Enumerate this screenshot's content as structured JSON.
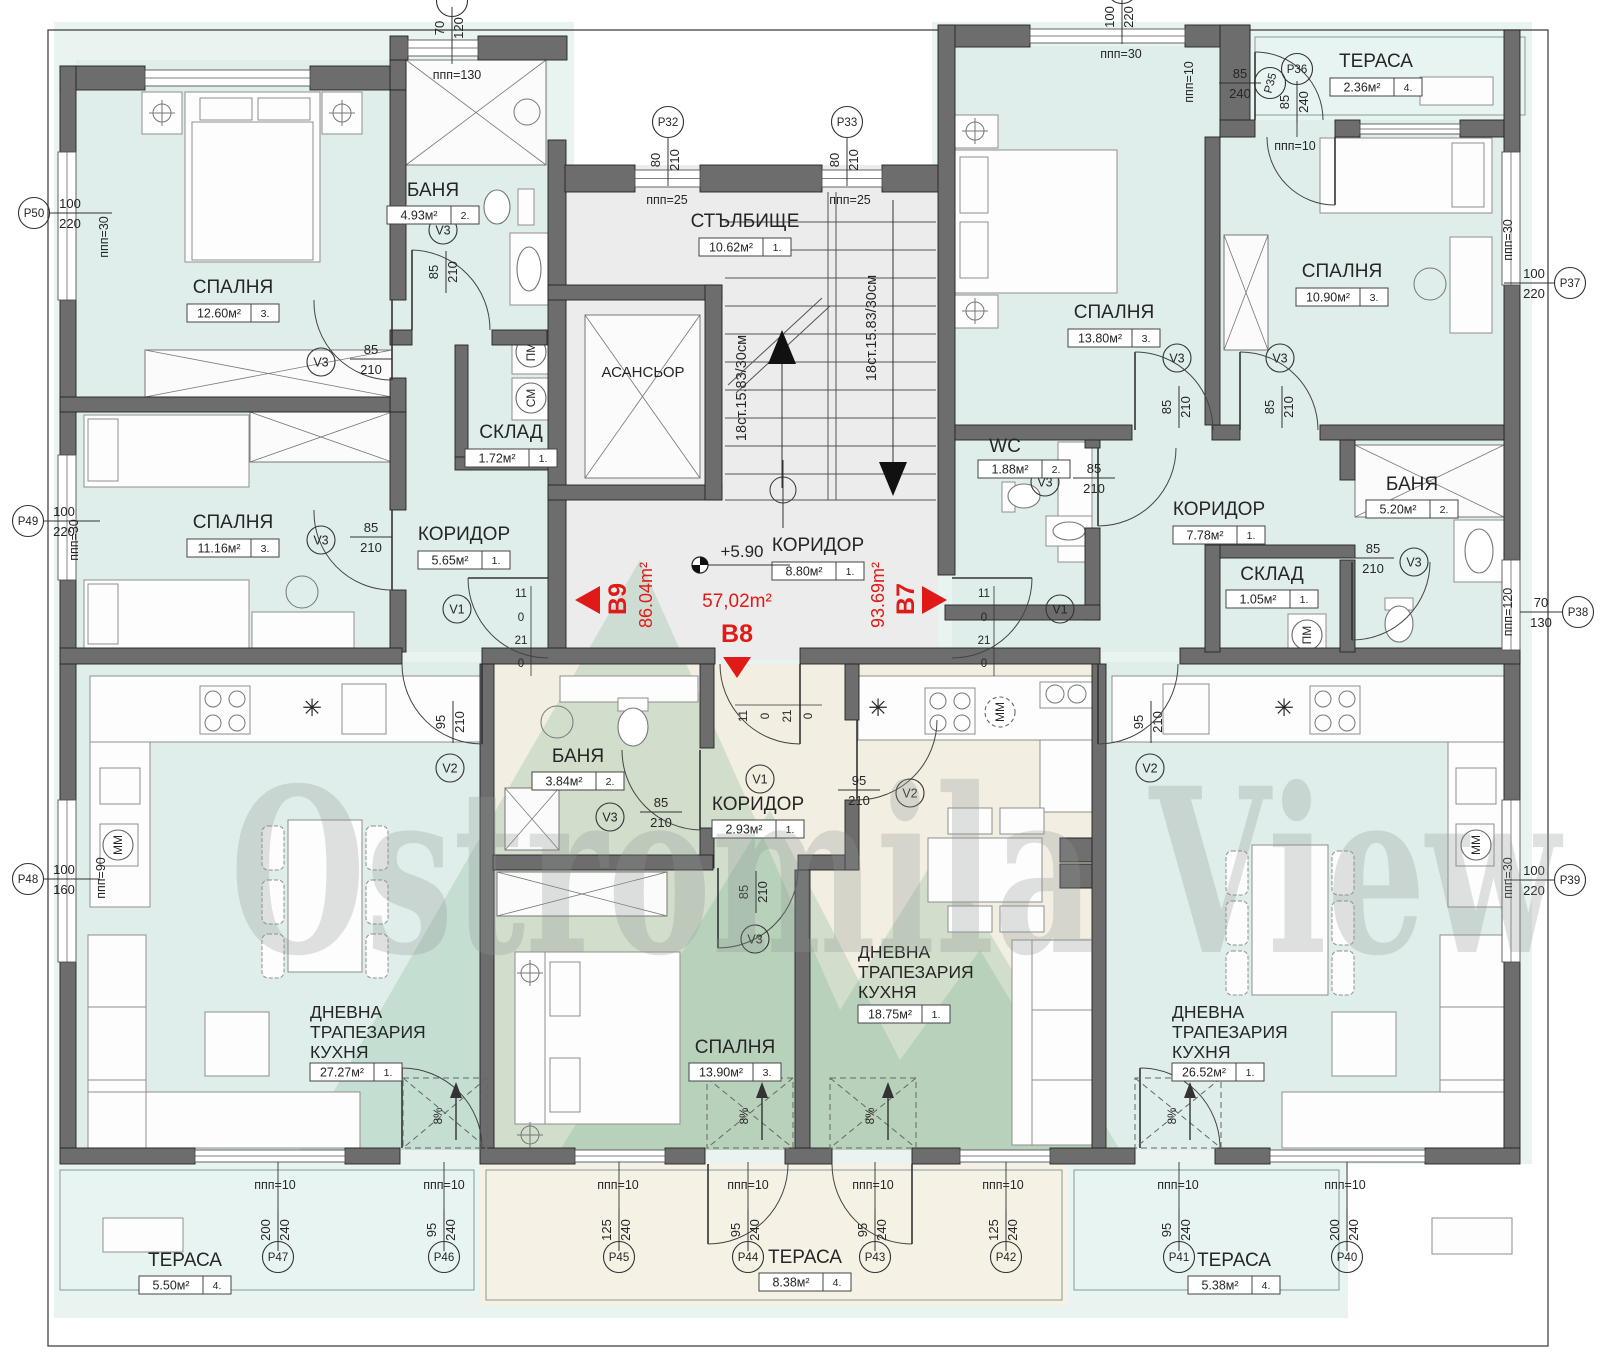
{
  "watermark": {
    "text": "Ostromila View"
  },
  "level_mark": "+5.90",
  "stair_note": "18ст.15.83/30см",
  "units": [
    {
      "id": "B9",
      "area": "86.04m²"
    },
    {
      "id": "B8",
      "area": "57,02m²"
    },
    {
      "id": "B7",
      "area": "93.69m²"
    }
  ],
  "rooms": [
    {
      "n": [
        "СПАЛНЯ"
      ],
      "a": "12.60м²",
      "u": "3.",
      "x": 233,
      "y": 293,
      "by": 313
    },
    {
      "n": [
        "БАНЯ"
      ],
      "a": "4.93м²",
      "u": "2.",
      "x": 433,
      "y": 196,
      "by": 215
    },
    {
      "n": [
        "СПАЛНЯ"
      ],
      "a": "11.16м²",
      "u": "3.",
      "x": 233,
      "y": 528,
      "by": 548
    },
    {
      "n": [
        "КОРИДОР"
      ],
      "a": "5.65м²",
      "u": "1.",
      "x": 464,
      "y": 540,
      "by": 560
    },
    {
      "n": [
        "СКЛАД"
      ],
      "a": "1.72м²",
      "u": "1.",
      "x": 511,
      "y": 438,
      "by": 458
    },
    {
      "n": [
        "СТЪЛБИЩЕ"
      ],
      "a": "10.62м²",
      "u": "1.",
      "x": 745,
      "y": 227,
      "by": 247
    },
    {
      "n": [
        "АСАНСЬОР"
      ],
      "x": 643,
      "y": 377,
      "nobox": 1
    },
    {
      "n": [
        "КОРИДОР"
      ],
      "a": "8.80м²",
      "u": "1.",
      "x": 818,
      "y": 551,
      "by": 571
    },
    {
      "n": [
        "СПАЛНЯ"
      ],
      "a": "13.80м²",
      "u": "3.",
      "x": 1114,
      "y": 318,
      "by": 338
    },
    {
      "n": [
        "СПАЛНЯ"
      ],
      "a": "10.90м²",
      "u": "3.",
      "x": 1342,
      "y": 277,
      "by": 297
    },
    {
      "n": [
        "ТЕРАСА"
      ],
      "a": "2.36м²",
      "u": "4.",
      "x": 1376,
      "y": 67,
      "by": 87
    },
    {
      "n": [
        "WC"
      ],
      "a": "1.88м²",
      "u": "2.",
      "x": 1005,
      "y": 452,
      "by": 469,
      "ax": 1024
    },
    {
      "n": [
        "КОРИДОР"
      ],
      "a": "7.78м²",
      "u": "1.",
      "x": 1219,
      "y": 515,
      "by": 535
    },
    {
      "n": [
        "БАНЯ"
      ],
      "a": "5.20м²",
      "u": "2.",
      "x": 1412,
      "y": 490,
      "by": 509
    },
    {
      "n": [
        "СКЛАД"
      ],
      "a": "1.05м²",
      "u": "1.",
      "x": 1272,
      "y": 580,
      "by": 599
    },
    {
      "n": [
        "БАНЯ"
      ],
      "a": "3.84м²",
      "u": "2.",
      "x": 578,
      "y": 762,
      "by": 781
    },
    {
      "n": [
        "КОРИДОР"
      ],
      "a": "2.93м²",
      "u": "1.",
      "x": 758,
      "y": 810,
      "by": 829
    },
    {
      "n": [
        "СПАЛНЯ"
      ],
      "a": "13.90м²",
      "u": "3.",
      "x": 735,
      "y": 1053,
      "by": 1072
    },
    {
      "n": [
        "ДНЕВНА",
        "ТРАПЕЗАРИЯ",
        "КУХНЯ"
      ],
      "a": "18.75м²",
      "u": "1.",
      "x": 858,
      "y": 958,
      "by": 1014,
      "left": 1
    },
    {
      "n": [
        "ДНЕВНА",
        "ТРАПЕЗАРИЯ",
        "КУХНЯ"
      ],
      "a": "27.27м²",
      "u": "1.",
      "x": 310,
      "y": 1018,
      "by": 1072,
      "left": 1
    },
    {
      "n": [
        "ДНЕВНА",
        "ТРАПЕЗАРИЯ",
        "КУХНЯ"
      ],
      "a": "26.52м²",
      "u": "1.",
      "x": 1172,
      "y": 1018,
      "by": 1072,
      "left": 1
    },
    {
      "n": [
        "ТЕРАСА"
      ],
      "a": "5.50м²",
      "u": "4.",
      "x": 185,
      "y": 1266,
      "by": 1285
    },
    {
      "n": [
        "ТЕРАСА"
      ],
      "a": "8.38м²",
      "u": "4.",
      "x": 805,
      "y": 1263,
      "by": 1282
    },
    {
      "n": [
        "ТЕРАСА"
      ],
      "a": "5.38м²",
      "u": "4.",
      "x": 1234,
      "y": 1266,
      "by": 1285
    }
  ],
  "p_markers": [
    {
      "id": "P50",
      "t": "100",
      "b": "220",
      "cx": 34,
      "cy": 213,
      "f": "h",
      "fx": 70,
      "fy": 213,
      "l": [
        49,
        213,
        112,
        213
      ]
    },
    {
      "id": "P49",
      "t": "100",
      "b": "220",
      "cx": 28,
      "cy": 521,
      "f": "h",
      "fx": 64,
      "fy": 521,
      "l": [
        43,
        521,
        100,
        521
      ]
    },
    {
      "id": "P48",
      "t": "100",
      "b": "160",
      "cx": 28,
      "cy": 879,
      "f": "h",
      "fx": 64,
      "fy": 879,
      "l": [
        43,
        879,
        100,
        879
      ]
    },
    {
      "id": "P37",
      "t": "100",
      "b": "220",
      "cx": 1570,
      "cy": 283,
      "f": "h",
      "fx": 1534,
      "fy": 283,
      "l": [
        1504,
        283,
        1555,
        283
      ]
    },
    {
      "id": "P38",
      "t": "70",
      "b": "130",
      "cx": 1578,
      "cy": 612,
      "f": "h",
      "fx": 1541,
      "fy": 612,
      "l": [
        1520,
        612,
        1563,
        612
      ]
    },
    {
      "id": "P39",
      "t": "100",
      "b": "220",
      "cx": 1570,
      "cy": 880,
      "f": "h",
      "fx": 1534,
      "fy": 880,
      "l": [
        1504,
        880,
        1555,
        880
      ]
    },
    {
      "id": "P32",
      "t": "80",
      "b": "210",
      "cx": 668,
      "cy": 122,
      "f": "v",
      "fx": 668,
      "fy": 160,
      "l": [
        668,
        137,
        668,
        186
      ]
    },
    {
      "id": "P33",
      "t": "80",
      "b": "210",
      "cx": 847,
      "cy": 122,
      "f": "v",
      "fx": 847,
      "fy": 160,
      "l": [
        847,
        137,
        847,
        186
      ]
    },
    {
      "id": "P35",
      "t": "85",
      "b": "240",
      "cx": 1270,
      "cy": 83,
      "f": "h",
      "fx": 1240,
      "fy": 83,
      "l": [
        1222,
        83,
        1256,
        83
      ],
      "crot": -75
    },
    {
      "id": "P36",
      "t": "85",
      "b": "240",
      "cx": 1297,
      "cy": 69,
      "f": "v",
      "fx": 1297,
      "fy": 102,
      "l": [
        1297,
        85,
        1297,
        137
      ]
    },
    {
      "id": "P47",
      "t": "200",
      "b": "240",
      "cx": 278,
      "cy": 1257,
      "f": "v",
      "fx": 278,
      "fy": 1230,
      "l": [
        278,
        1242,
        278,
        1162
      ]
    },
    {
      "id": "P46",
      "t": "95",
      "b": "240",
      "cx": 444,
      "cy": 1257,
      "f": "v",
      "fx": 444,
      "fy": 1230,
      "l": [
        444,
        1242,
        444,
        1162
      ]
    },
    {
      "id": "P45",
      "t": "125",
      "b": "240",
      "cx": 619,
      "cy": 1257,
      "f": "v",
      "fx": 619,
      "fy": 1230,
      "l": [
        619,
        1242,
        619,
        1162
      ]
    },
    {
      "id": "P44",
      "t": "95",
      "b": "240",
      "cx": 748,
      "cy": 1257,
      "f": "v",
      "fx": 748,
      "fy": 1230,
      "l": [
        748,
        1242,
        748,
        1162
      ]
    },
    {
      "id": "P43",
      "t": "95",
      "b": "240",
      "cx": 875,
      "cy": 1257,
      "f": "v",
      "fx": 875,
      "fy": 1230,
      "l": [
        875,
        1242,
        875,
        1162
      ]
    },
    {
      "id": "P42",
      "t": "125",
      "b": "240",
      "cx": 1006,
      "cy": 1257,
      "f": "v",
      "fx": 1006,
      "fy": 1230,
      "l": [
        1006,
        1242,
        1006,
        1162
      ]
    },
    {
      "id": "P41",
      "t": "95",
      "b": "240",
      "cx": 1179,
      "cy": 1257,
      "f": "v",
      "fx": 1179,
      "fy": 1230,
      "l": [
        1179,
        1242,
        1179,
        1162
      ]
    },
    {
      "id": "P40",
      "t": "200",
      "b": "240",
      "cx": 1347,
      "cy": 1257,
      "f": "v",
      "fx": 1347,
      "fy": 1230,
      "l": [
        1347,
        1242,
        1347,
        1162
      ]
    },
    {
      "id": "",
      "t": "70",
      "b": "120",
      "cx": 452,
      "cy": 1,
      "f": "v",
      "fx": 452,
      "fy": 28,
      "l": [
        452,
        16,
        452,
        64
      ]
    },
    {
      "id": "",
      "t": "100",
      "b": "220",
      "cx": 1122,
      "cy": -12,
      "f": "v",
      "fx": 1122,
      "fy": 17,
      "l": [
        1122,
        4,
        1122,
        44
      ]
    }
  ],
  "v_markers": [
    {
      "id": "V3",
      "cx": 443,
      "cy": 230,
      "t": "85",
      "b": "210",
      "f": "v",
      "fx": 446,
      "fy": 272
    },
    {
      "id": "V3",
      "cx": 321,
      "cy": 362,
      "t": "85",
      "b": "210",
      "f": "h",
      "fx": 371,
      "fy": 359
    },
    {
      "id": "V3",
      "cx": 321,
      "cy": 540,
      "t": "85",
      "b": "210",
      "f": "h",
      "fx": 371,
      "fy": 537
    },
    {
      "id": "V1",
      "cx": 457,
      "cy": 609
    },
    {
      "id": "V1",
      "cx": 1060,
      "cy": 609
    },
    {
      "id": "V2",
      "cx": 450,
      "cy": 768,
      "t": "95",
      "b": "210",
      "f": "v",
      "fx": 453,
      "fy": 722
    },
    {
      "id": "V2",
      "cx": 1150,
      "cy": 768,
      "t": "95",
      "b": "210",
      "f": "v",
      "fx": 1151,
      "fy": 722
    },
    {
      "id": "V3",
      "cx": 610,
      "cy": 817,
      "t": "85",
      "b": "210",
      "f": "h",
      "fx": 661,
      "fy": 812
    },
    {
      "id": "V1",
      "cx": 760,
      "cy": 779
    },
    {
      "id": "V3",
      "cx": 755,
      "cy": 939,
      "t": "85",
      "b": "210",
      "f": "v",
      "fx": 756,
      "fy": 892
    },
    {
      "id": "V2",
      "cx": 910,
      "cy": 793,
      "t": "95",
      "b": "210",
      "f": "h",
      "fx": 859,
      "fy": 790
    },
    {
      "id": "V3",
      "cx": 1045,
      "cy": 482,
      "t": "85",
      "b": "210",
      "f": "h",
      "fx": 1094,
      "fy": 478
    },
    {
      "id": "V3",
      "cx": 1414,
      "cy": 562,
      "t": "85",
      "b": "210",
      "f": "h",
      "fx": 1373,
      "fy": 558
    },
    {
      "id": "V3",
      "cx": 1177,
      "cy": 358,
      "t": "85",
      "b": "210",
      "f": "v",
      "fx": 1179,
      "fy": 407
    },
    {
      "id": "V3",
      "cx": 1280,
      "cy": 358,
      "t": "85",
      "b": "210",
      "f": "v",
      "fx": 1282,
      "fy": 407
    }
  ],
  "ppp": [
    {
      "t": "ппп=130",
      "x": 457,
      "y": 79
    },
    {
      "t": "ппп=30",
      "x": 108,
      "y": 237,
      "r": 1
    },
    {
      "t": "ппп=30",
      "x": 78,
      "y": 540,
      "r": 1
    },
    {
      "t": "ппп=90",
      "x": 105,
      "y": 878,
      "r": 1
    },
    {
      "t": "ппп=25",
      "x": 667,
      "y": 204
    },
    {
      "t": "ппп=25",
      "x": 850,
      "y": 204
    },
    {
      "t": "ппп=30",
      "x": 1121,
      "y": 58
    },
    {
      "t": "ппп=10",
      "x": 1193,
      "y": 82,
      "r": 1
    },
    {
      "t": "ппп=10",
      "x": 1295,
      "y": 150
    },
    {
      "t": "ппп=30",
      "x": 1512,
      "y": 240,
      "r": 1
    },
    {
      "t": "ппп=120",
      "x": 1512,
      "y": 612,
      "r": 1
    },
    {
      "t": "ппп=30",
      "x": 1512,
      "y": 878,
      "r": 1
    },
    {
      "t": "ппп=10",
      "x": 275,
      "y": 1189
    },
    {
      "t": "ппп=10",
      "x": 444,
      "y": 1189
    },
    {
      "t": "ппп=10",
      "x": 618,
      "y": 1189
    },
    {
      "t": "ппп=10",
      "x": 748,
      "y": 1189
    },
    {
      "t": "ппп=10",
      "x": 873,
      "y": 1189
    },
    {
      "t": "ппп=10",
      "x": 1003,
      "y": 1189
    },
    {
      "t": "ппп=10",
      "x": 1178,
      "y": 1189
    },
    {
      "t": "ппп=10",
      "x": 1345,
      "y": 1189
    }
  ],
  "door_dims": [
    {
      "t": "11",
      "x": 521,
      "y": 597
    },
    {
      "t": "0",
      "x": 521,
      "y": 621
    },
    {
      "t": "21",
      "x": 521,
      "y": 644
    },
    {
      "t": "0",
      "x": 521,
      "y": 667
    },
    {
      "t": "11",
      "x": 984,
      "y": 597
    },
    {
      "t": "0",
      "x": 984,
      "y": 621
    },
    {
      "t": "21",
      "x": 984,
      "y": 644
    },
    {
      "t": "0",
      "x": 984,
      "y": 667
    },
    {
      "t": "11",
      "x": 747,
      "y": 716,
      "r": 1
    },
    {
      "t": "0",
      "x": 769,
      "y": 716,
      "r": 1
    },
    {
      "t": "21",
      "x": 791,
      "y": 716,
      "r": 1
    },
    {
      "t": "0",
      "x": 812,
      "y": 716,
      "r": 1
    }
  ],
  "appliances": [
    {
      "t": "ПМ",
      "x": 531,
      "y": 352
    },
    {
      "t": "СМ",
      "x": 531,
      "y": 398
    },
    {
      "t": "ММ",
      "x": 118,
      "y": 845
    },
    {
      "t": "ММ",
      "x": 1000,
      "y": 712,
      "dash": 1
    },
    {
      "t": "ММ",
      "x": 1476,
      "y": 845
    },
    {
      "t": "ПМ",
      "x": 1307,
      "y": 635
    }
  ],
  "ramp_label": "8%",
  "stair_arrows": {
    "up": "782,330 768,364 796,364",
    "down": "893,496 879,462 907,462"
  }
}
